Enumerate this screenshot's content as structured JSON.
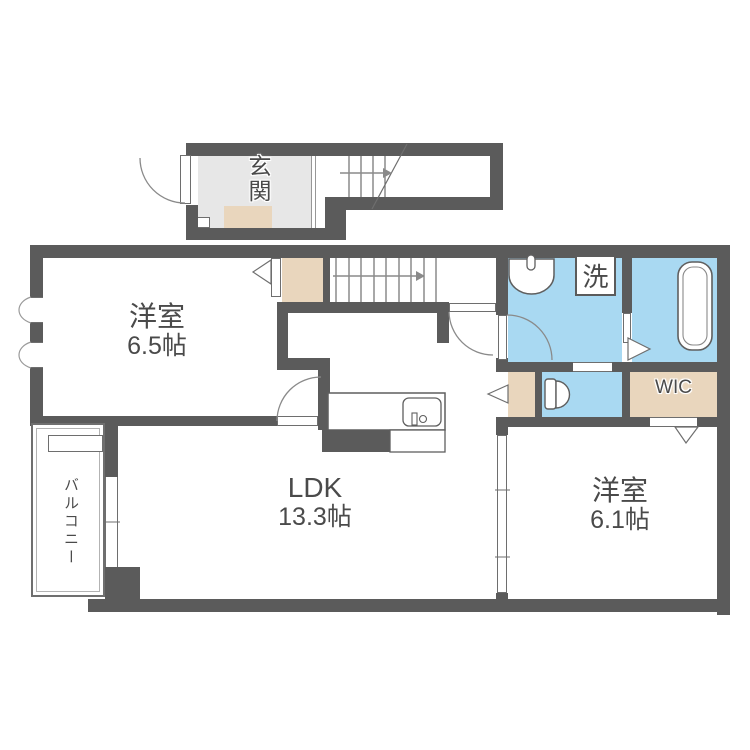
{
  "title": "1LDK-type apartment floor plan",
  "rooms": {
    "entrance": {
      "name": "玄関"
    },
    "bedroom_65": {
      "name": "洋室",
      "area": "6.5帖"
    },
    "ldk": {
      "name": "LDK",
      "area": "13.3帖"
    },
    "bedroom_61": {
      "name": "洋室",
      "area": "6.1帖"
    },
    "wic": {
      "name": "WIC"
    },
    "laundry": {
      "name": "洗"
    },
    "balcony": {
      "name": "バルコニー"
    }
  },
  "colors": {
    "wall": "#5b5b5b",
    "wet_floor": "#a9d9f2",
    "storage_floor": "#e9d6bd",
    "entrance_floor": "#e7e7e7",
    "text": "#4a4a4a"
  }
}
